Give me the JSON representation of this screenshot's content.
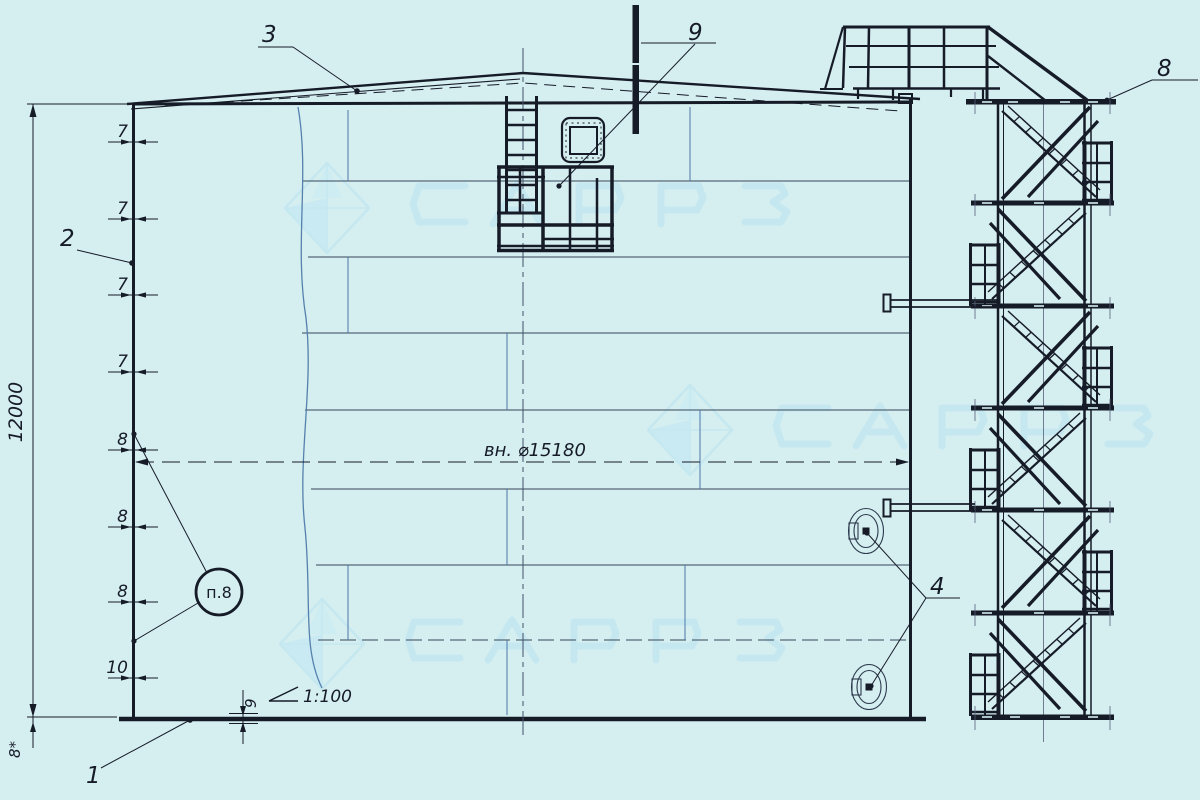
{
  "callouts": {
    "pos1": "1",
    "pos2": "2",
    "pos3": "3",
    "pos4": "4",
    "pos8": "8",
    "pos9": "9"
  },
  "dimensions": {
    "total_height": "12000",
    "bottom_plate_left": "8*",
    "bottom_plate_edge": "9",
    "slope": "1:100",
    "inner_diameter": "вн. ⌀15180",
    "courses": [
      "7",
      "7",
      "7",
      "7",
      "8",
      "8",
      "8",
      "10"
    ]
  },
  "weld_note": "п.8",
  "colors": {
    "background": "#d5eef0",
    "line": "#161b28",
    "steel_blue": "#5581ad",
    "watermark": "#b9e4f1"
  }
}
